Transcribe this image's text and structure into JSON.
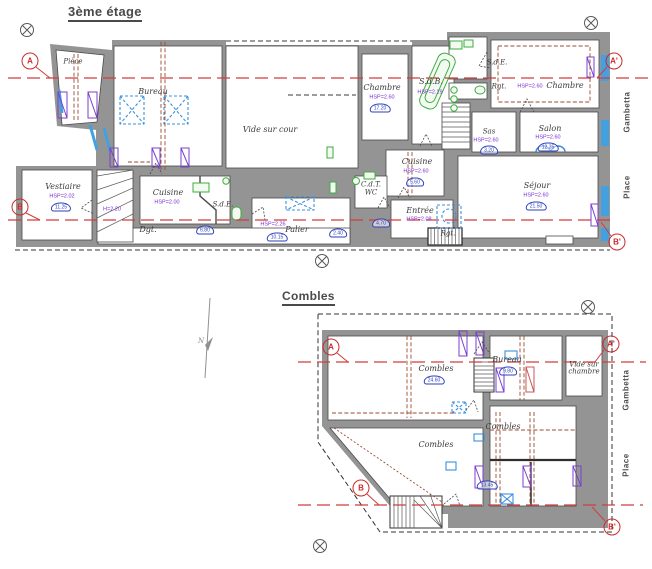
{
  "colors": {
    "wall": "#949494",
    "section_line": "#d23c3c",
    "window": "#44a1e0",
    "fixture": "#3fae3f",
    "radiator": "#7a3fd0",
    "area_badge": "#2c3fbe",
    "beam": "#9a4a32"
  },
  "plan_etage": {
    "title": "3ème étage",
    "rooms": {
      "piece": "Pièce",
      "bureau": "Bureau",
      "vide_sur_cour": "Vide sur cour",
      "chambre_left": "Chambre",
      "sdb": "S.d.B.",
      "sde_top": "S.d.E.",
      "rgt_top": "Rgt.",
      "chambre_right": "Chambre",
      "sas": "Sas",
      "salon": "Salon",
      "sejour": "Séjour",
      "cuisine_center": "Cuisine",
      "cdt": "C.d.T.",
      "wc": "WC",
      "entree": "Entrée",
      "rgt_bottom": "Rgt.",
      "palier": "Palier",
      "cuisine_left": "Cuisine",
      "sde_left": "S.d.E.",
      "dgt": "Dgt.",
      "vestiaire": "Vestiaire"
    },
    "ceiling_heights": {
      "chambre_left": "HSP=2.60",
      "sdb": "HSP=2.19",
      "chambre_right": "HSP=2.60",
      "sas": "HSP=2.60",
      "salon": "HSP=2.60",
      "sejour": "HSP=2.60",
      "cuisine_center": "HSP=2.60",
      "entree": "HSP=2.08",
      "palier": "HSP=2.26",
      "cuisine_left": "HSP=2.00",
      "vestiaire": "HSP=2.02",
      "stairs": "H=2.20"
    },
    "areas": {
      "chambre_left": "17.20",
      "sas": "3.20",
      "salon": "12.35",
      "sejour": "21.50",
      "cuisine_center": "5.60",
      "entree": "4.70",
      "palier": "10.15",
      "palier2": "2.40",
      "dgt": "6.80",
      "vestiaire": "11.25"
    },
    "streets": {
      "gambetta": "Gambetta",
      "place": "Place"
    },
    "markers": {
      "a": "A",
      "a_prime": "A'",
      "b": "B",
      "b_prime": "B'"
    }
  },
  "plan_combles": {
    "title": "Combles",
    "rooms": {
      "combles_nw": "Combles",
      "bureau": "Bureau",
      "vide_sur_chambre": "Vide sur chambre",
      "combles_mid": "Combles",
      "combles_sw": "Combles"
    },
    "areas": {
      "combles_nw": "24.60",
      "bureau": "9.80",
      "combles_bottom": "13.45"
    },
    "streets": {
      "gambetta": "Gambetta",
      "place": "Place"
    },
    "markers": {
      "a": "A",
      "a_prime": "A'",
      "b": "B",
      "b_prime": "B'"
    }
  },
  "north_arrow": {
    "label": "N"
  }
}
